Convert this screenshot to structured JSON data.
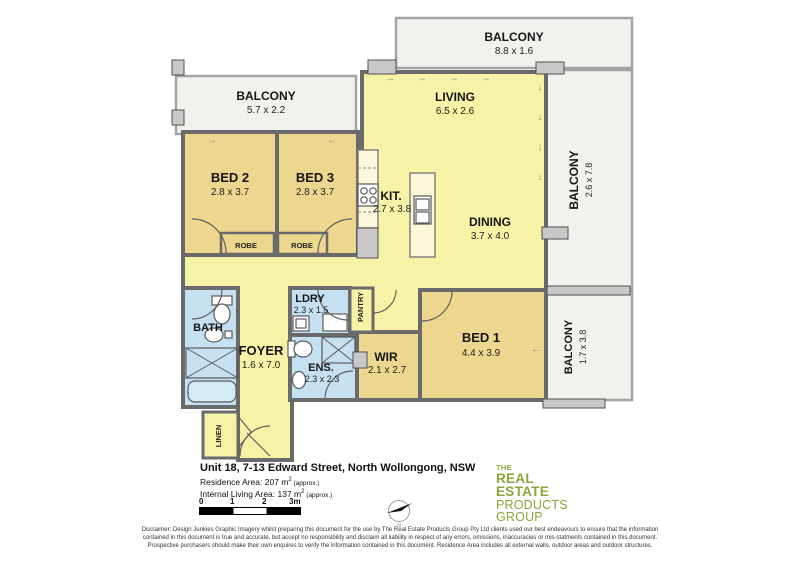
{
  "plan": {
    "rooms": {
      "balcony_top": {
        "label": "BALCONY",
        "dims": "8.8 x 1.6"
      },
      "balcony_left": {
        "label": "BALCONY",
        "dims": "5.7 x 2.2"
      },
      "balcony_right": {
        "label": "BALCONY",
        "dims": "2.6 x 7.8"
      },
      "balcony_right_lower": {
        "label": "BALCONY",
        "dims": "1.7 x 3.8"
      },
      "living": {
        "label": "LIVING",
        "dims": "6.5 x 2.6"
      },
      "dining": {
        "label": "DINING",
        "dims": "3.7 x 4.0"
      },
      "kitchen": {
        "label": "KIT.",
        "dims": "2.7 x 3.8"
      },
      "bed1": {
        "label": "BED 1",
        "dims": "4.4 x 3.9"
      },
      "bed2": {
        "label": "BED 2",
        "dims": "2.8 x 3.7"
      },
      "bed3": {
        "label": "BED 3",
        "dims": "2.8 x 3.7"
      },
      "wir": {
        "label": "WIR",
        "dims": "2.1 x 2.7"
      },
      "ens": {
        "label": "ENS.",
        "dims": "2.3 x 2.3"
      },
      "ldry": {
        "label": "LDRY",
        "dims": "2.3 x 1.5"
      },
      "bath": {
        "label": "BATH"
      },
      "foyer": {
        "label": "FOYER",
        "dims": "1.6 x 7.0"
      },
      "robe": {
        "label": "ROBE"
      },
      "pantry": {
        "label": "PANTRY"
      },
      "linen": {
        "label": "LINEN"
      }
    },
    "colors": {
      "open_plan": "#f6f2a6",
      "bedroom": "#edd78f",
      "wet_area": "#c4e0f1",
      "balcony": "#f1f1ee",
      "wall": "#6a6a6a"
    },
    "icons": {
      "arrow_right": "→",
      "arrow_left": "←",
      "arrow_down": "↓"
    }
  },
  "title_block": {
    "address": "Unit 18, 7-13 Edward Street, North Wollongong, NSW",
    "residence_area": {
      "prefix": "Residence Area: 207 m",
      "sup": "2",
      "suffix": " (approx.)"
    },
    "living_area": {
      "prefix": "Internal Living Area: 137 m",
      "sup": "2",
      "suffix": " (approx.)"
    },
    "scale_ticks": [
      "0",
      "1",
      "2",
      "3m"
    ],
    "north_label": "N"
  },
  "logo": {
    "lines": [
      "THE",
      "REAL",
      "ESTATE",
      "PRODUCTS",
      "GROUP"
    ],
    "color": "#8ba43c"
  },
  "disclaimer": "Disclaimer: Design Junkies Graphic Imagery whilst preparing this document for the use by The Real Estate Products Group Pty Ltd clients used our best endeavours to ensure that the information contained in this document is true and accurate, but accept no responsibility and disclaim all liability in respect of any errors, omissions, inaccuracies or mis-statments contained in this document. Prospective purchasers should make their own enquires to verify the information contained in this document. Residence Area includes all external walls, outdoor areas and outdoor structures."
}
